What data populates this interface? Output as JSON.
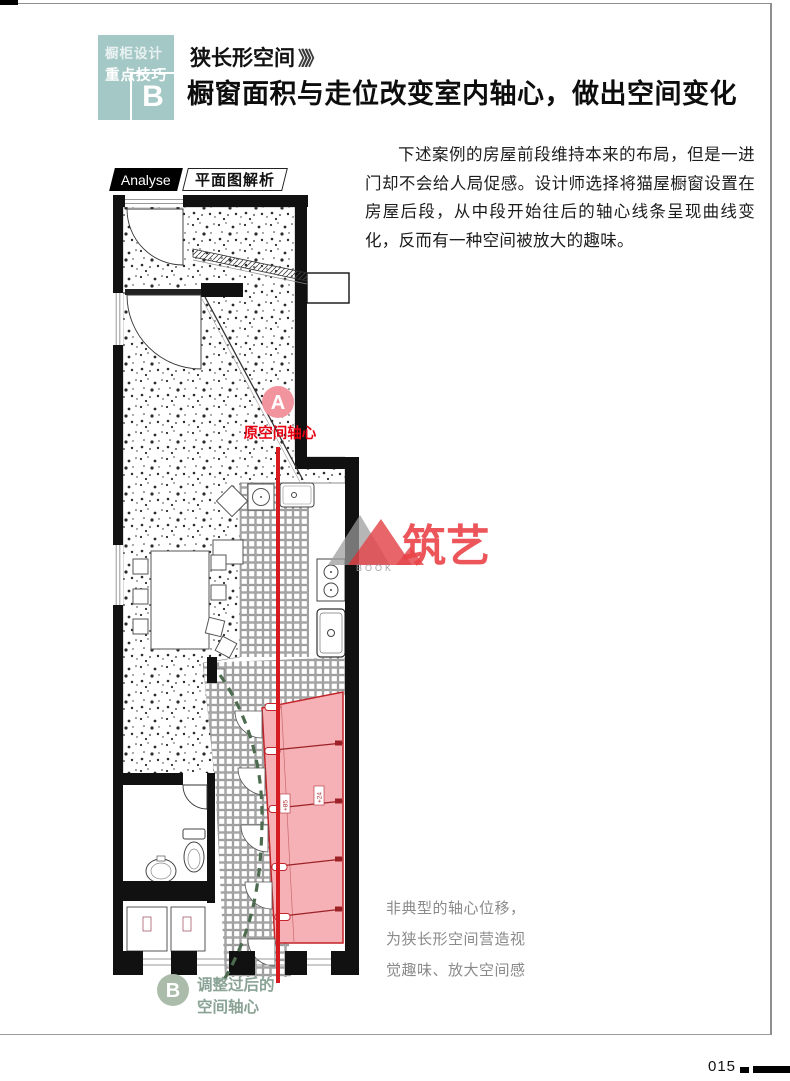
{
  "page": {
    "number": "015"
  },
  "header": {
    "tag": {
      "line1": "橱柜设计",
      "line2": "重点技巧",
      "letter": "B"
    },
    "subtitle": "狭长形空间",
    "subtitle_arrows": "》》》",
    "title": "橱窗面积与走位改变室内轴心，做出空间变化"
  },
  "analyse": {
    "en": "Analyse",
    "zh": "平面图解析"
  },
  "body": {
    "paragraph": "下述案例的房屋前段维持本来的布局，但是一进门却不会给人局促感。设计师选择将猫屋橱窗设置在房屋后段，从中段开始往后的轴心线条呈现曲线变化，反而有一种空间被放大的趣味。"
  },
  "plan": {
    "marker_a": {
      "letter": "A",
      "label": "原空间轴心"
    },
    "marker_b": {
      "letter": "B",
      "label_line1": "调整过后的",
      "label_line2": "空间轴心"
    },
    "cabinet_tags": {
      "tag1": "+85",
      "tag2": "+24"
    },
    "colors": {
      "axis_original": "#d71920",
      "axis_adjusted": "#4d6b4f",
      "cabinet_fill": "#f5b1b5",
      "cabinet_border": "#c2242a",
      "marker_a_fill": "#f2949e",
      "marker_b_fill": "#abbcab",
      "header_teal": "#a4c8c6"
    }
  },
  "caption": {
    "line1": "非典型的轴心位移，",
    "line2": "为狭长形空间营造视",
    "line3": "觉趣味、放大空间感"
  },
  "watermark": {
    "brand": "筑艺",
    "sub": "BOOK"
  }
}
